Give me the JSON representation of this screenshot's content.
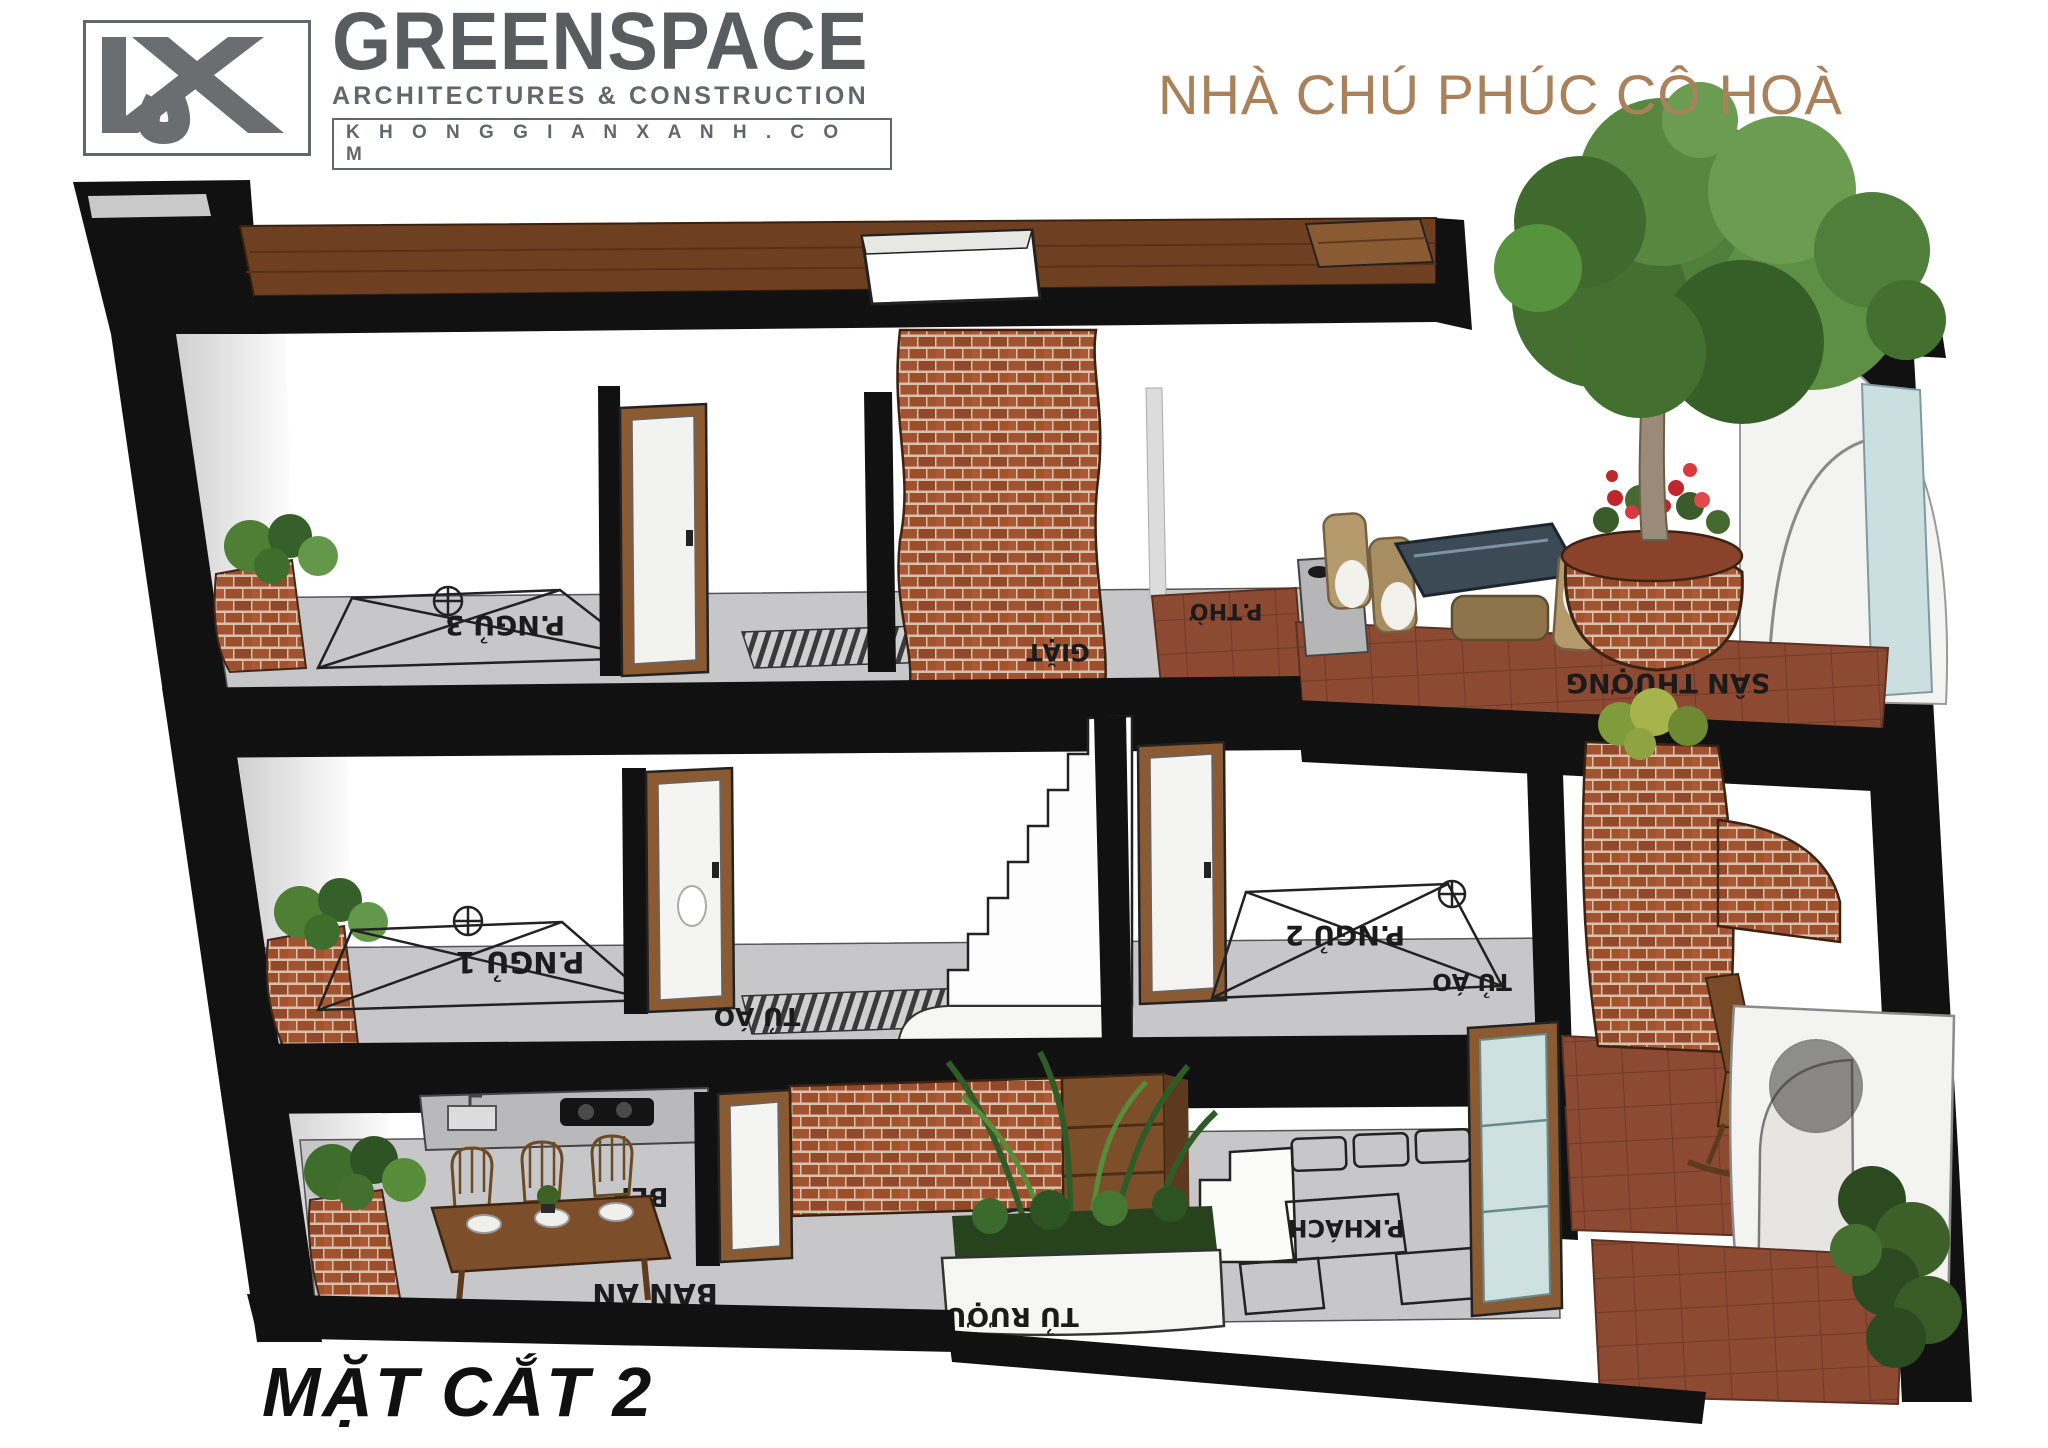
{
  "header": {
    "logo_mark": "KGX",
    "brand": "GREENSPACE",
    "tagline": "ARCHITECTURES & CONSTRUCTION",
    "website": "K H O N G G I A N X A N H . C O M"
  },
  "project_title": "NHÀ CHÚ PHÚC CÔ HOÀ",
  "section_label": "MẶT CẮT 2",
  "floors": {
    "top": {
      "bedroom3": "P.NGỦ 3",
      "laundry": "GIẶT",
      "worship": "P.THỜ",
      "terrace": "SÂN THƯỢNG"
    },
    "middle": {
      "bedroom1": "P.NGỦ 1",
      "wardrobe_left": "TỦ ÁO",
      "bedroom2": "P.NGỦ 2",
      "wardrobe_right": "TỦ ÁO"
    },
    "ground": {
      "kitchen": "BẾP",
      "dining": "BÀN ĂN",
      "bar": "BAR",
      "wine_cabinet": "TỦ RƯỢU",
      "living": "P.KHÁCH"
    }
  },
  "colors": {
    "title_brown": "#A9825C",
    "logo_gray": "#63666A",
    "brick": "#9E5130",
    "tile_red": "#8D4A33",
    "wood_deck": "#6F3F21",
    "slab_black": "#111111",
    "floor_gray": "#C7C7C9"
  }
}
